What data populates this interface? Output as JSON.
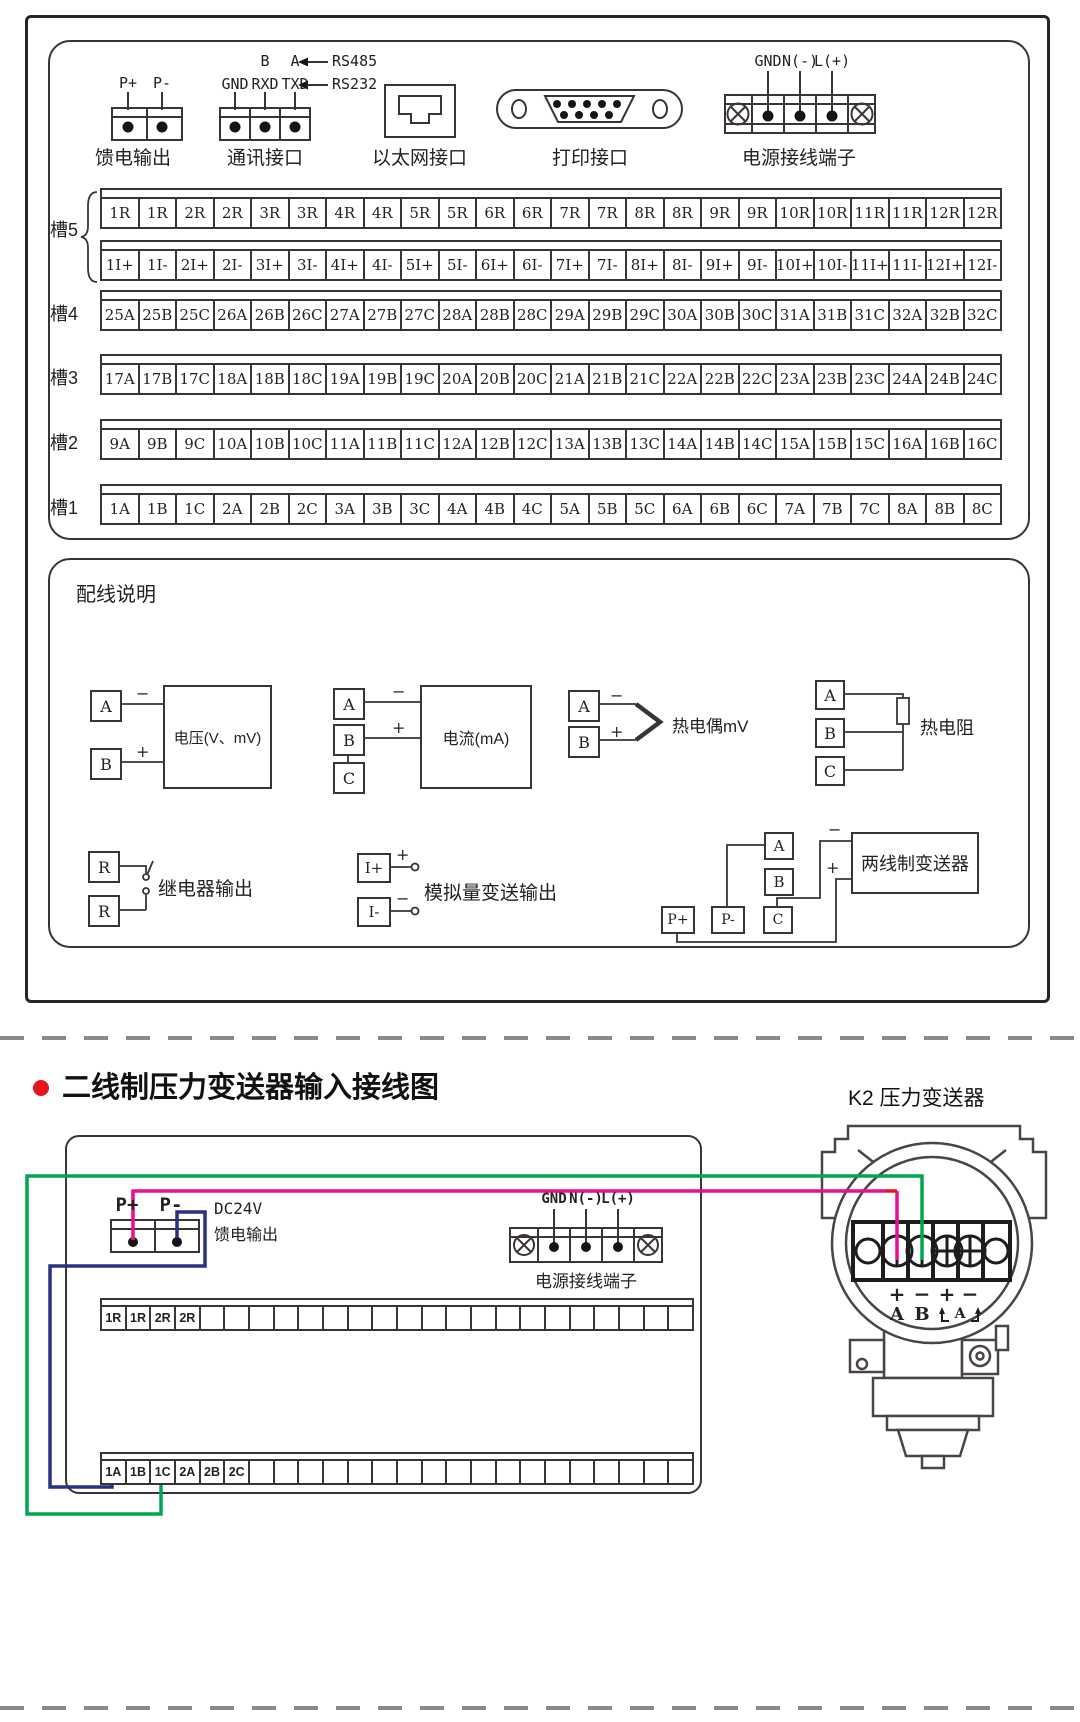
{
  "colors": {
    "line": "#3a3434",
    "wire_green": "#00a550",
    "wire_pink": "#ec0f8c",
    "wire_blue": "#28327e",
    "wire_red": "#e8141c",
    "bullet_red": "#e8141c"
  },
  "top_panel": {
    "connectors": {
      "feed": {
        "p_plus": "P+",
        "p_minus": "P-",
        "label": "馈电输出"
      },
      "comm": {
        "b": "B",
        "a": "A",
        "rs485": "RS485",
        "rs232": "RS232",
        "gnd": "GND",
        "rxd": "RXD",
        "txd": "TXD",
        "label": "通讯接口"
      },
      "ethernet": {
        "label": "以太网接口"
      },
      "printer": {
        "label": "打印接口"
      },
      "power": {
        "gnd": "GND",
        "n": "N(-)",
        "l": "L(+)",
        "label": "电源接线端子"
      }
    },
    "slots": [
      {
        "name": "槽5",
        "rows": [
          [
            "1R",
            "1R",
            "2R",
            "2R",
            "3R",
            "3R",
            "4R",
            "4R",
            "5R",
            "5R",
            "6R",
            "6R",
            "7R",
            "7R",
            "8R",
            "8R",
            "9R",
            "9R",
            "10R",
            "10R",
            "11R",
            "11R",
            "12R",
            "12R"
          ],
          [
            "1I+",
            "1I-",
            "2I+",
            "2I-",
            "3I+",
            "3I-",
            "4I+",
            "4I-",
            "5I+",
            "5I-",
            "6I+",
            "6I-",
            "7I+",
            "7I-",
            "8I+",
            "8I-",
            "9I+",
            "9I-",
            "10I+",
            "10I-",
            "11I+",
            "11I-",
            "12I+",
            "12I-"
          ]
        ]
      },
      {
        "name": "槽4",
        "rows": [
          [
            "25A",
            "25B",
            "25C",
            "26A",
            "26B",
            "26C",
            "27A",
            "27B",
            "27C",
            "28A",
            "28B",
            "28C",
            "29A",
            "29B",
            "29C",
            "30A",
            "30B",
            "30C",
            "31A",
            "31B",
            "31C",
            "32A",
            "32B",
            "32C"
          ]
        ]
      },
      {
        "name": "槽3",
        "rows": [
          [
            "17A",
            "17B",
            "17C",
            "18A",
            "18B",
            "18C",
            "19A",
            "19B",
            "19C",
            "20A",
            "20B",
            "20C",
            "21A",
            "21B",
            "21C",
            "22A",
            "22B",
            "22C",
            "23A",
            "23B",
            "23C",
            "24A",
            "24B",
            "24C"
          ]
        ]
      },
      {
        "name": "槽2",
        "rows": [
          [
            "9A",
            "9B",
            "9C",
            "10A",
            "10B",
            "10C",
            "11A",
            "11B",
            "11C",
            "12A",
            "12B",
            "12C",
            "13A",
            "13B",
            "13C",
            "14A",
            "14B",
            "14C",
            "15A",
            "15B",
            "15C",
            "16A",
            "16B",
            "16C"
          ]
        ]
      },
      {
        "name": "槽1",
        "rows": [
          [
            "1A",
            "1B",
            "1C",
            "2A",
            "2B",
            "2C",
            "3A",
            "3B",
            "3C",
            "4A",
            "4B",
            "4C",
            "5A",
            "5B",
            "5C",
            "6A",
            "6B",
            "6C",
            "7A",
            "7B",
            "7C",
            "8A",
            "8B",
            "8C"
          ]
        ]
      }
    ],
    "wiring": {
      "title": "配线说明",
      "voltage": {
        "a": "A",
        "b": "B",
        "minus": "−",
        "plus": "+",
        "label": "电压(V、mV)"
      },
      "current": {
        "a": "A",
        "b": "B",
        "c": "C",
        "minus": "−",
        "plus": "+",
        "label": "电流(mA)"
      },
      "thermocouple": {
        "a": "A",
        "b": "B",
        "minus": "−",
        "plus": "+",
        "label": "热电偶mV"
      },
      "rtd": {
        "a": "A",
        "b": "B",
        "c": "C",
        "label": "热电阻"
      },
      "relay": {
        "r1": "R",
        "r2": "R",
        "label": "继电器输出"
      },
      "analog_out": {
        "i_plus": "I+",
        "i_minus": "I-",
        "plus": "+",
        "minus": "−",
        "label": "模拟量变送输出"
      },
      "two_wire": {
        "a": "A",
        "b": "B",
        "p_plus": "P+",
        "p_minus": "P-",
        "c": "C",
        "minus": "−",
        "plus": "+",
        "label": "两线制变送器"
      }
    }
  },
  "bottom_section": {
    "title": "二线制压力变送器输入接线图",
    "transmitter_title": "K2 压力变送器",
    "recorder": {
      "p_plus": "P+",
      "p_minus": "P-",
      "dc24v_line1": "DC24V",
      "dc24v_line2": "馈电输出",
      "power": {
        "gnd": "GND",
        "n": "N(-)",
        "l": "L(+)",
        "label": "电源接线端子"
      },
      "top_strip": [
        "1R",
        "1R",
        "2R",
        "2R",
        "",
        "",
        "",
        "",
        "",
        "",
        "",
        "",
        "",
        "",
        "",
        "",
        "",
        "",
        "",
        "",
        "",
        "",
        "",
        ""
      ],
      "bottom_strip": [
        "1A",
        "1B",
        "1C",
        "2A",
        "2B",
        "2C",
        "",
        "",
        "",
        "",
        "",
        "",
        "",
        "",
        "",
        "",
        "",
        "",
        "",
        "",
        "",
        "",
        "",
        ""
      ]
    },
    "transmitter": {
      "p1": "+",
      "m1": "−",
      "p2": "+",
      "m2": "−",
      "t_a": "A",
      "t_b": "B",
      "alt": "A"
    }
  }
}
